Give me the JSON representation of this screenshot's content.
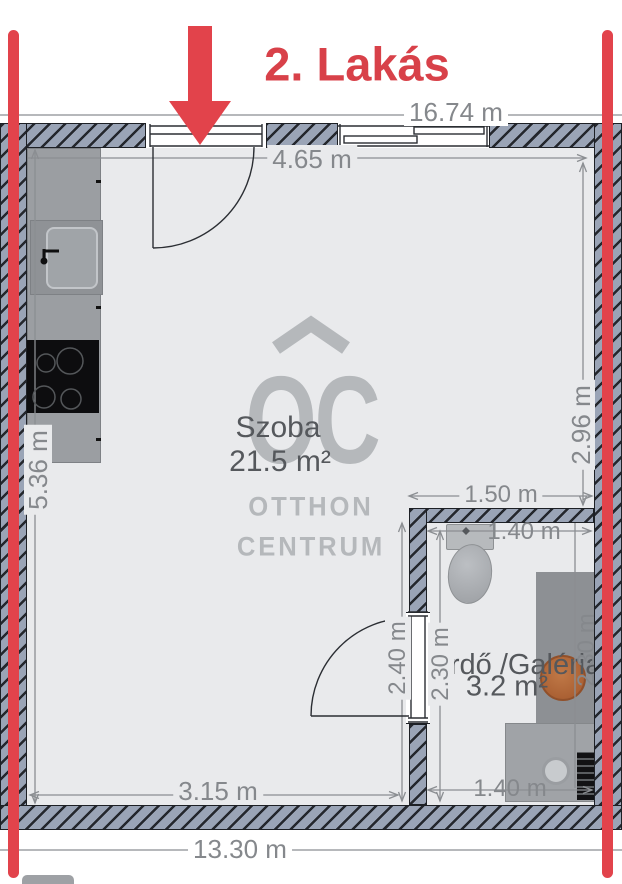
{
  "title": "2. Lakás",
  "rooms": {
    "main": {
      "name": "Szoba",
      "area": "21.5 m²"
    },
    "bath": {
      "name": "Fürdő /Galéria",
      "area": "3.2 m²"
    }
  },
  "dimensions": {
    "total_top": "16.74 m",
    "room_width": "4.65 m",
    "right_height": "2.96 m",
    "left_height": "5.36 m",
    "bath_outer_width": "1.50 m",
    "bath_inner_width": "1.40 m",
    "door_strip_height": "2.40 m",
    "bath_inner_height": "2.30 m",
    "bath_side_height": "2.30 m",
    "bottom_left_width": "3.15 m",
    "bath_bottom_width": "1.40 m",
    "total_bottom": "13.30 m"
  },
  "watermark": {
    "monogram": "OC",
    "line1": "OTTHON",
    "line2": "CENTRUM"
  },
  "colors": {
    "marker_red": "#e2434b",
    "title_red": "#d84149",
    "wall_fill": "#9aa4b6",
    "floor": "#e9eaec",
    "dimension_text": "#85888c",
    "room_text": "#55585c",
    "watermark_gray": "#b5b8bb",
    "bath_sink_orange": "#ad5f33"
  }
}
